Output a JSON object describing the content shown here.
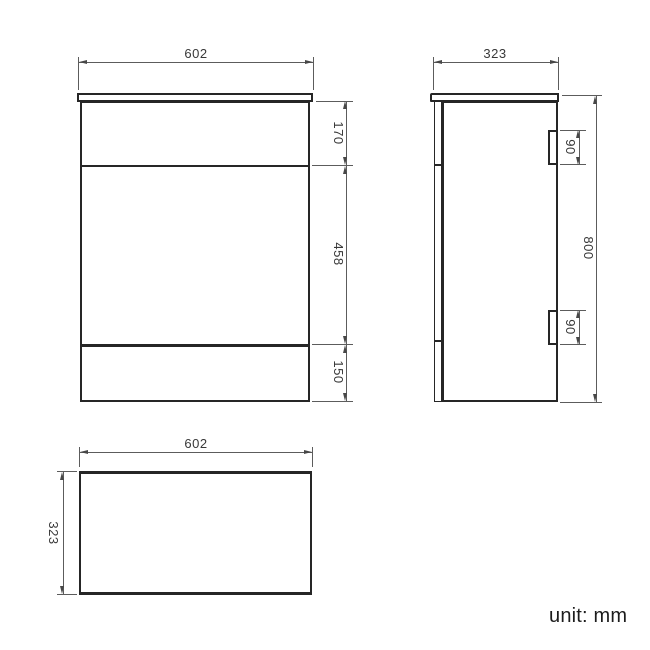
{
  "footer": {
    "unit_note": "unit: mm"
  },
  "views": {
    "front": {
      "width_label": "602",
      "section_labels": [
        "170",
        "458",
        "150"
      ]
    },
    "side": {
      "depth_label": "323",
      "height_label": "800",
      "hinge_labels": [
        "90",
        "90"
      ]
    },
    "plan": {
      "width_label": "602",
      "depth_label": "323"
    }
  },
  "colors": {
    "geometry_line": "#262626",
    "dimension_line": "#5c5c5c",
    "dimension_text": "#383838",
    "background": "#ffffff"
  },
  "drawing_data": {
    "type": "technical-drawing",
    "unit": "mm",
    "dimensions": {
      "overall_width": 602,
      "overall_depth": 323,
      "overall_height": 800,
      "front_sections_top_to_bottom": [
        170,
        458,
        150
      ],
      "hinge_plate_height": 90,
      "hinge_count": 2
    }
  }
}
